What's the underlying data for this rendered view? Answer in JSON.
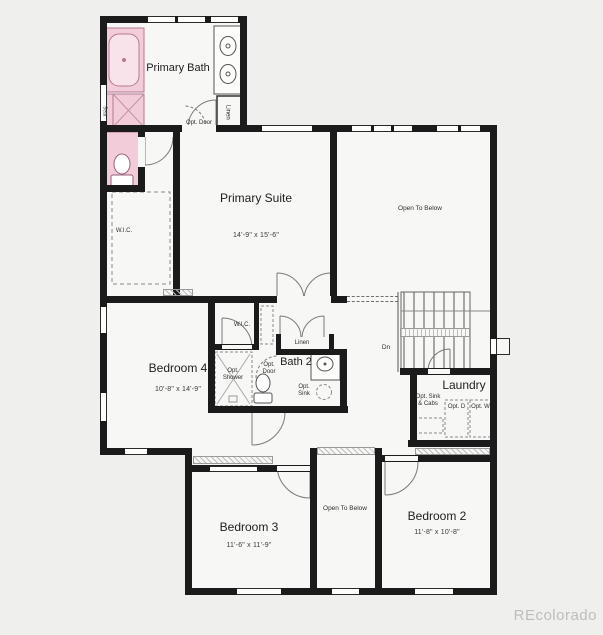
{
  "watermark": "REcolorado",
  "colors": {
    "wall": "#1b1b1b",
    "floor": "#f7f7f5",
    "background": "#efefed",
    "fixture_pink": "#f2ccd8",
    "fixture_pink_stroke": "#b57893",
    "watermark_gray": "#bdbdbd"
  },
  "rooms": {
    "primary_bath": {
      "name": "Primary Bath"
    },
    "primary_suite": {
      "name": "Primary Suite",
      "dims": "14'-9\" x 15'-6\""
    },
    "open_to_below_large": {
      "name": "Open To Below"
    },
    "bedroom_4": {
      "name": "Bedroom 4",
      "dims": "10'-8\" x 14'-9\""
    },
    "bath_2": {
      "name": "Bath 2"
    },
    "laundry": {
      "name": "Laundry"
    },
    "bedroom_3": {
      "name": "Bedroom 3",
      "dims": "11'-6\" x 11'-9\""
    },
    "bedroom_2": {
      "name": "Bedroom 2",
      "dims": "11'-8\" x 10'-8\""
    },
    "open_to_below_small": {
      "name": "Open To Below"
    }
  },
  "annotations": {
    "wic_primary": "W.I.C.",
    "wic_bedroom4": "W.I.C.",
    "linen_primary": "Linen",
    "linen_hall": "Linen",
    "seat": "Seat",
    "opt_door_primary": "Opt. Door",
    "opt_door_bath2": "Opt. Door",
    "opt_shower": "Opt. Shower",
    "opt_sink": "Opt. Sink",
    "opt_sink_cabs": "Opt. Sink & Cabs",
    "opt_dryer": "Opt. D",
    "opt_washer": "Opt. W",
    "down": "Dn"
  }
}
